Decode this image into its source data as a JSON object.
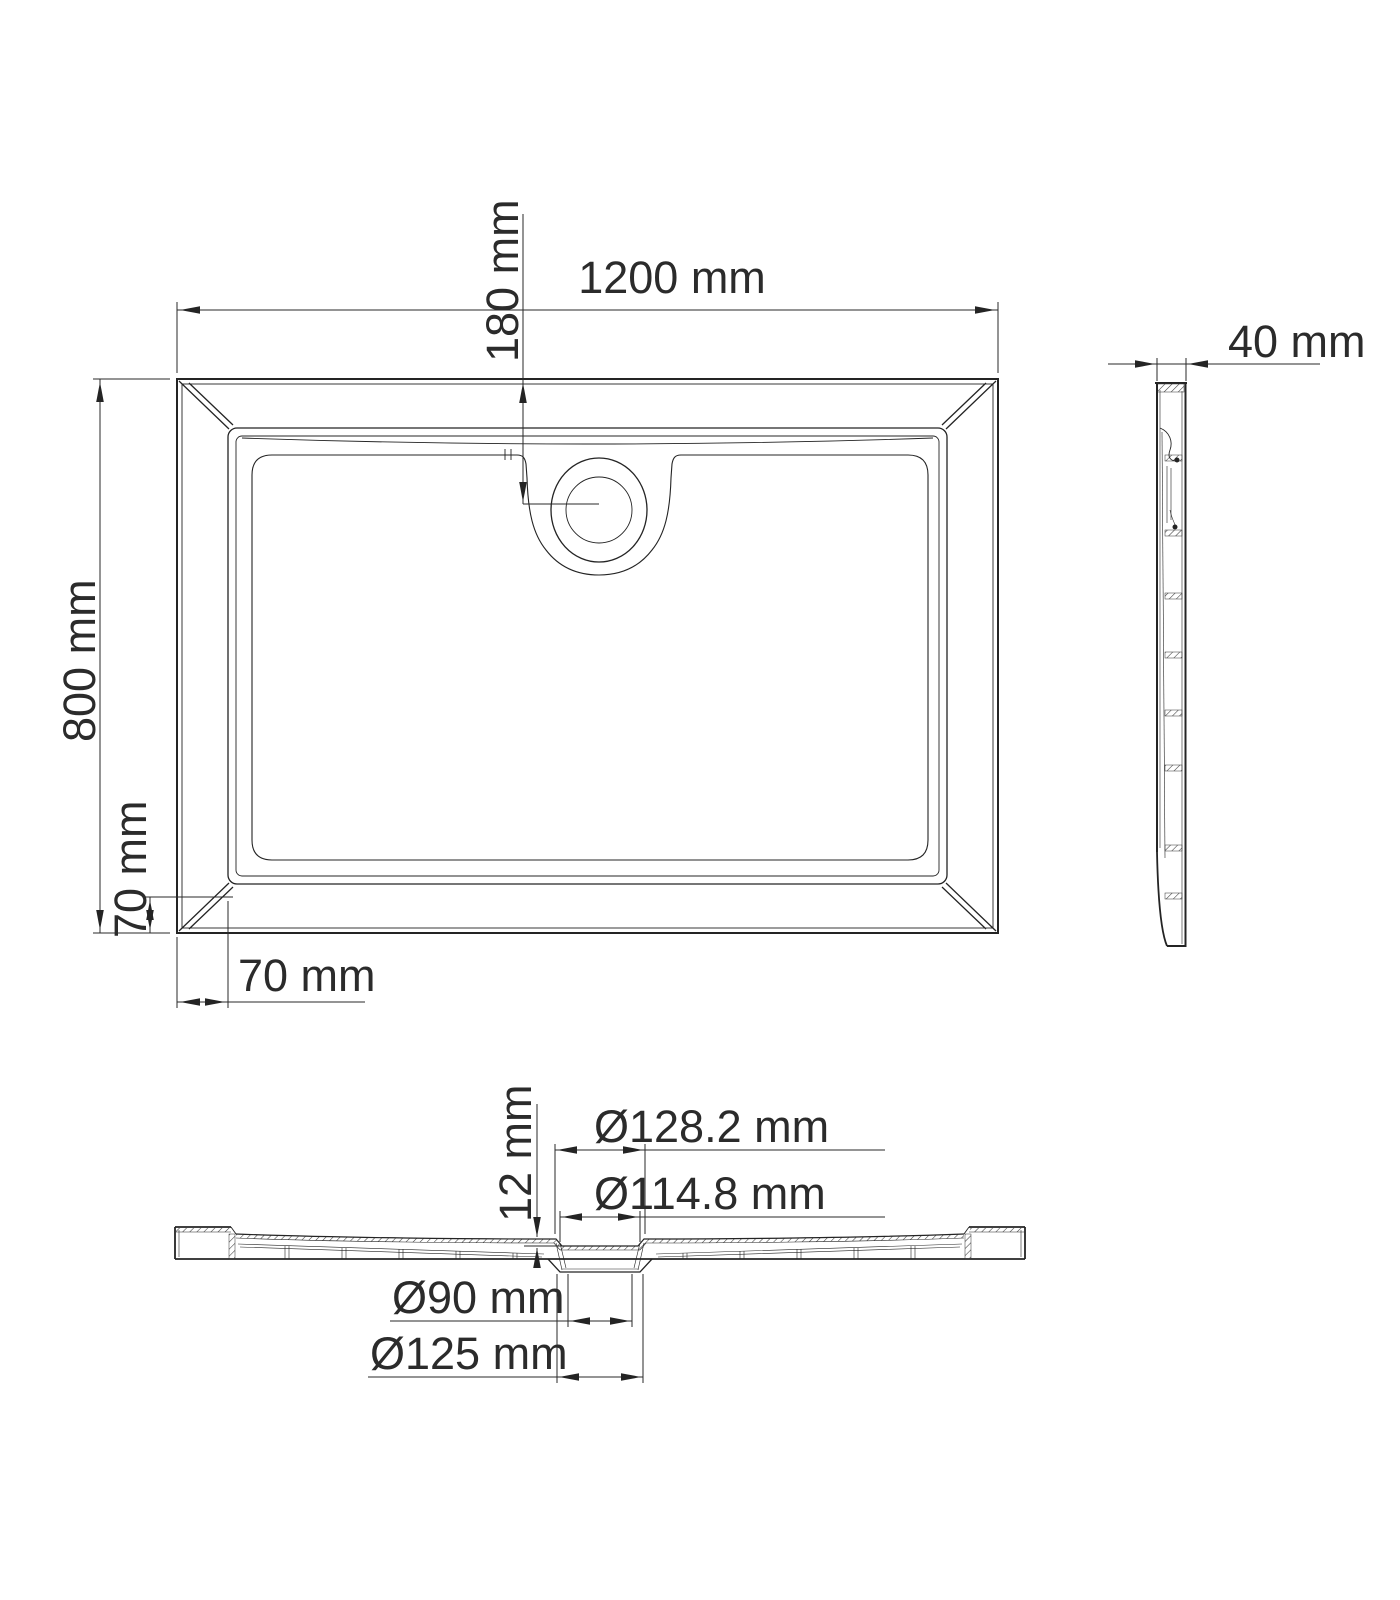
{
  "views": {
    "top": {
      "width": "1200 mm",
      "height": "800 mm",
      "drain_offset": "180 mm",
      "corner_offset_vertical": "70 mm",
      "corner_offset_horizontal": "70 mm"
    },
    "side": {
      "thickness": "40 mm"
    },
    "section": {
      "recess_depth": "12 mm",
      "diameters": {
        "outer_top": "Ø128.2 mm",
        "inner_top": "Ø114.8 mm",
        "bottom_inner": "Ø90 mm",
        "bottom_outer": "Ø125 mm"
      }
    }
  }
}
